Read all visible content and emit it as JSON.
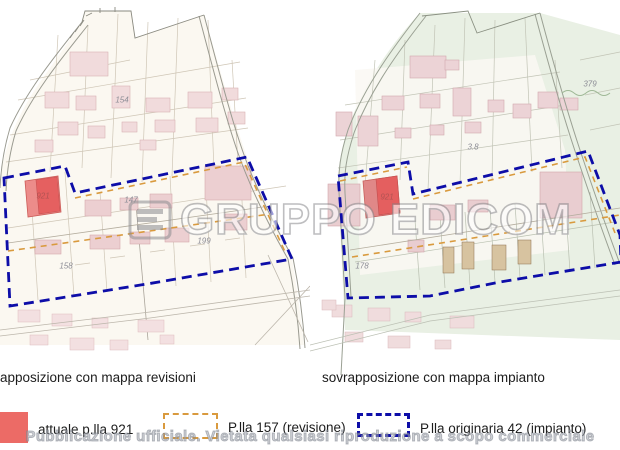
{
  "watermark": {
    "text": "GRUPPO EDICOM",
    "logo_icon": "edicom-logo"
  },
  "footer_notice": "Pubblicazione ufficiale. Vietata qualsiasi riproduzione a scopo commerciale",
  "panels": {
    "left": {
      "caption": "apposizione con mappa revisioni",
      "labels": [
        {
          "text": "154"
        },
        {
          "text": "147"
        },
        {
          "text": "199"
        },
        {
          "text": "158"
        },
        {
          "text": "921"
        }
      ]
    },
    "right": {
      "caption": "sovrapposizione con mappa impianto",
      "labels": [
        {
          "text": "921"
        },
        {
          "text": "379"
        },
        {
          "text": "3.8"
        },
        {
          "text": "178"
        }
      ]
    }
  },
  "legend": {
    "items": [
      {
        "label": "attuale p.lla 921",
        "swatch": "red-fill",
        "color": "#ec6b66"
      },
      {
        "label": "P.lla 157 (revisione)",
        "swatch": "orange-dashed-outline",
        "color": "#d99a3e"
      },
      {
        "label": "P.lla originaria 42 (impianto)",
        "swatch": "blue-dashed-outline",
        "color": "#0d0da8"
      }
    ]
  },
  "colors": {
    "boundary_blue": "#0d0da8",
    "revision_orange": "#d99a3e",
    "parcel_red": "#ec6b66",
    "map_green": "#e9f0e4",
    "building_pink": "#f1dbdc"
  }
}
